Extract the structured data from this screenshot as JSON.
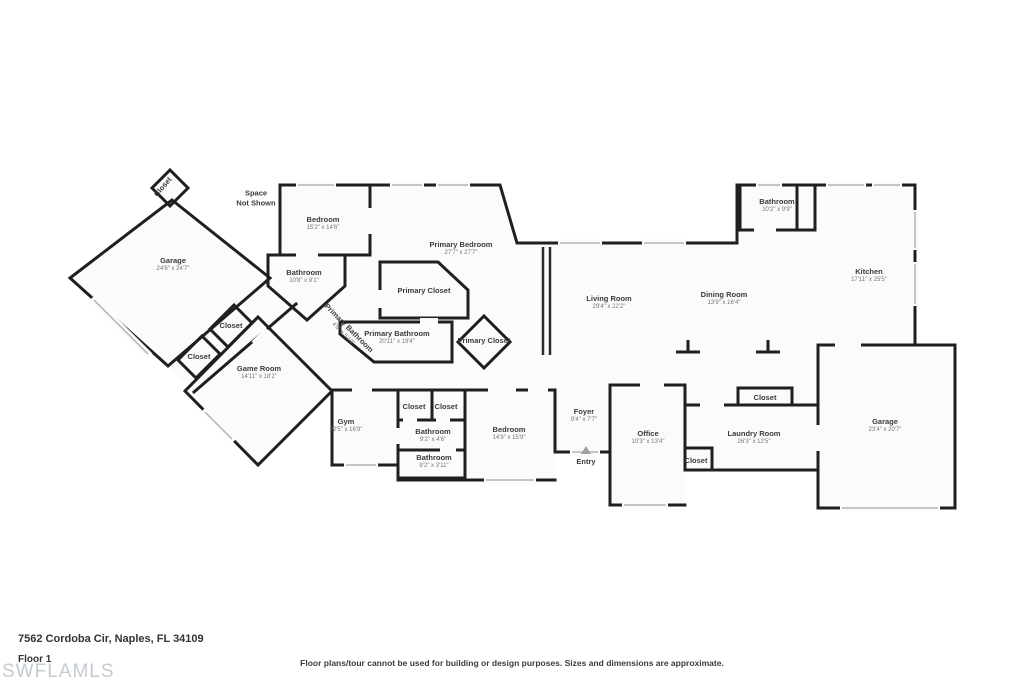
{
  "footer": {
    "address": "7562 Cordoba Cir, Naples, FL 34109",
    "floor_label": "Floor 1",
    "watermark": "SWFLAMLS",
    "disclaimer": "Floor plans/tour cannot be used for building or design purposes. Sizes and dimensions are approximate."
  },
  "plan": {
    "note": "Space\nNot Shown",
    "rooms": {
      "closet_garage_top": {
        "name": "Closet"
      },
      "garage_left": {
        "name": "Garage",
        "dims": "24'8\" x 24'7\""
      },
      "bedroom_top": {
        "name": "Bedroom",
        "dims": "15'2\" x 14'6\""
      },
      "primary_bedroom": {
        "name": "Primary Bedroom",
        "dims": "27'7\" x 27'7\""
      },
      "bathroom_guest": {
        "name": "Bathroom",
        "dims": "10'8\" x 8'1\""
      },
      "primary_closet_1": {
        "name": "Primary Closet"
      },
      "closet_hall_1": {
        "name": "Closet"
      },
      "primary_bathroom_small": {
        "name": "Primary Bathroom",
        "dims": "4'8\" x 5'10\""
      },
      "primary_bathroom": {
        "name": "Primary Bathroom",
        "dims": "20'11\" x 19'4\""
      },
      "primary_closet_2": {
        "name": "Primary Closet"
      },
      "closet_hall_2": {
        "name": "Closet"
      },
      "game_room": {
        "name": "Game Room",
        "dims": "14'11\" x 18'2\""
      },
      "living_room": {
        "name": "Living Room",
        "dims": "29'4\" x 22'2\""
      },
      "dining_room": {
        "name": "Dining Room",
        "dims": "13'9\" x 16'4\""
      },
      "kitchen": {
        "name": "Kitchen",
        "dims": "17'11\" x 25'5\""
      },
      "bathroom_top_right": {
        "name": "Bathroom",
        "dims": "10'2\" x 9'9\""
      },
      "gym": {
        "name": "Gym",
        "dims": "22'5\" x 16'9\""
      },
      "closet_a": {
        "name": "Closet"
      },
      "closet_b": {
        "name": "Closet"
      },
      "bathroom_mid_1": {
        "name": "Bathroom",
        "dims": "9'2\" x 4'6\""
      },
      "bathroom_mid_2": {
        "name": "Bathroom",
        "dims": "9'2\" x 3'11\""
      },
      "bedroom_mid": {
        "name": "Bedroom",
        "dims": "14'9\" x 15'9\""
      },
      "foyer": {
        "name": "Foyer",
        "dims": "9'4\" x 7'7\""
      },
      "entry": {
        "name": "Entry"
      },
      "office": {
        "name": "Office",
        "dims": "10'3\" x 13'4\""
      },
      "closet_laundry_top": {
        "name": "Closet"
      },
      "laundry_room": {
        "name": "Laundry Room",
        "dims": "26'3\" x 12'5\""
      },
      "closet_office": {
        "name": "Closet"
      },
      "garage_right": {
        "name": "Garage",
        "dims": "23'4\" x 20'7\""
      }
    }
  }
}
